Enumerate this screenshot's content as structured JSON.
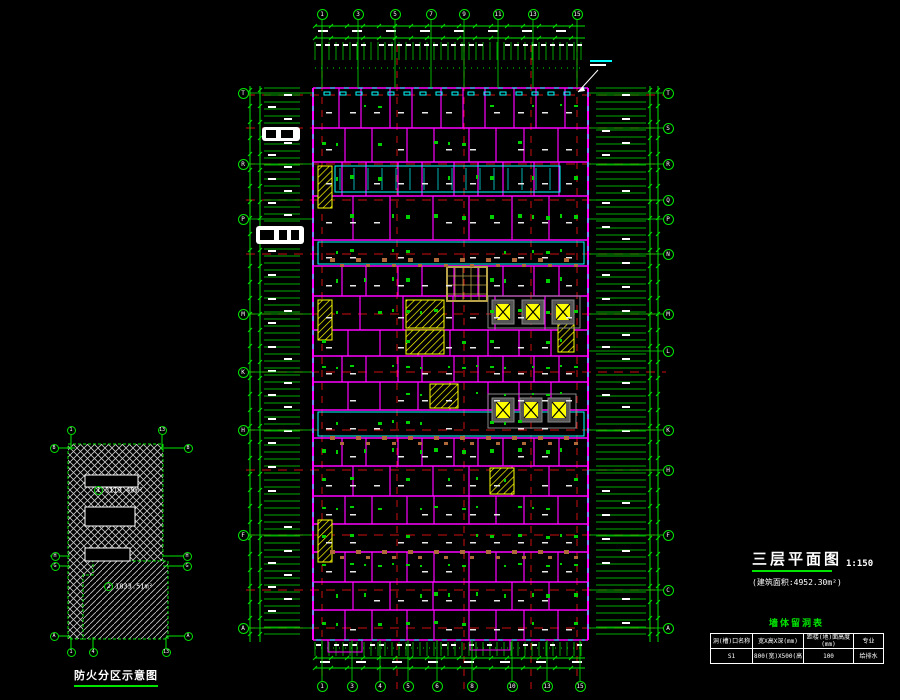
{
  "title_block": {
    "title": "三层平面图",
    "scale": "1:150",
    "area_note": "(建筑面积:4952.30m²)"
  },
  "opening_table": {
    "title": "墙体留洞表",
    "headers": [
      "洞(槽)口名称",
      "宽X高X深(mm)",
      "距楼(地)面高度(mm)",
      "专业"
    ],
    "rows": [
      [
        "S1",
        "800(宽)X500(高)X150",
        "100",
        "给排水"
      ]
    ]
  },
  "fire_diagram": {
    "caption": "防火分区示意图",
    "zones": [
      {
        "symbol": "1",
        "area": "3119.49m²"
      },
      {
        "symbol": "2",
        "area": "1833.51m²"
      }
    ],
    "bubbles": [
      "1",
      "13",
      "B",
      "B",
      "H",
      "G",
      "H",
      "G",
      "A",
      "A",
      "1",
      "4",
      "13"
    ]
  },
  "plan_grid": {
    "top_bubbles": [
      "1",
      "3",
      "5",
      "7",
      "9",
      "11",
      "13",
      "15"
    ],
    "bottom_bubbles": [
      "1",
      "3",
      "4",
      "5",
      "6",
      "8",
      "10",
      "13",
      "15"
    ],
    "left_bubbles": [
      "T",
      "R",
      "P",
      "M",
      "K",
      "H",
      "F",
      "A"
    ],
    "right_bubbles": [
      "T",
      "S",
      "R",
      "Q",
      "P",
      "N",
      "M",
      "L",
      "K",
      "H",
      "F",
      "C",
      "A"
    ]
  },
  "colors": {
    "grid_green": "#00e400",
    "wall_magenta": "#ff00ff",
    "axis_red": "#cc1111",
    "window_cyan": "#00ffff",
    "stair_yellow": "#ffff00",
    "text_white": "#ffffff"
  }
}
